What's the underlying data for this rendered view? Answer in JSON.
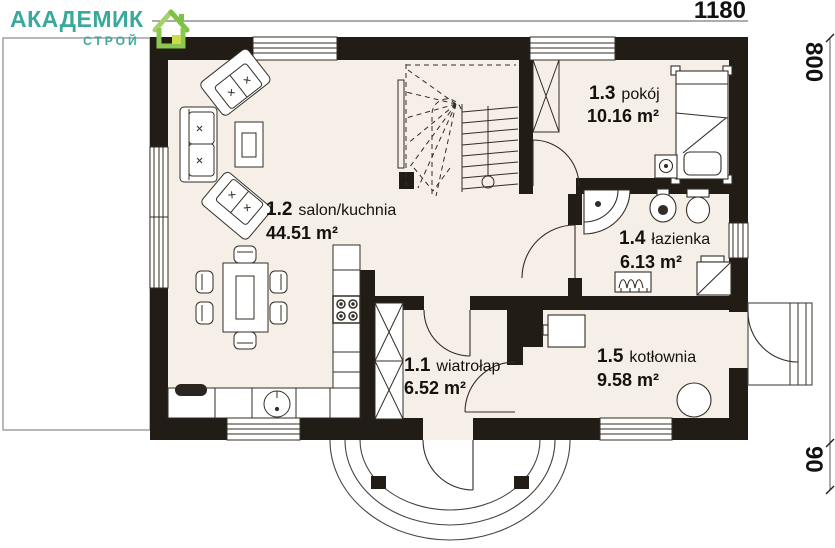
{
  "header": {
    "logo": {
      "title": "АКАДЕМИК",
      "subtitle": "СТРОЙ",
      "icon": "house-icon",
      "brand_teal": "#3aa89b",
      "brand_green": "#7dc242"
    },
    "dimensions": {
      "width": "1180",
      "height": "800",
      "porch_depth": "90"
    }
  },
  "plan": {
    "rooms": [
      {
        "id": "1.1",
        "name": "wiatrołap",
        "area": "6.52 m²"
      },
      {
        "id": "1.2",
        "name": "salon/kuchnia",
        "area": "44.51 m²"
      },
      {
        "id": "1.3",
        "name": "pokój",
        "area": "10.16 m²"
      },
      {
        "id": "1.4",
        "name": "łazienka",
        "area": "6.13 m²"
      },
      {
        "id": "1.5",
        "name": "kotłownia",
        "area": "9.58 m²"
      }
    ],
    "colors": {
      "wall": "#211c16",
      "floor": "#f5efe8",
      "line": "#332d26"
    }
  }
}
